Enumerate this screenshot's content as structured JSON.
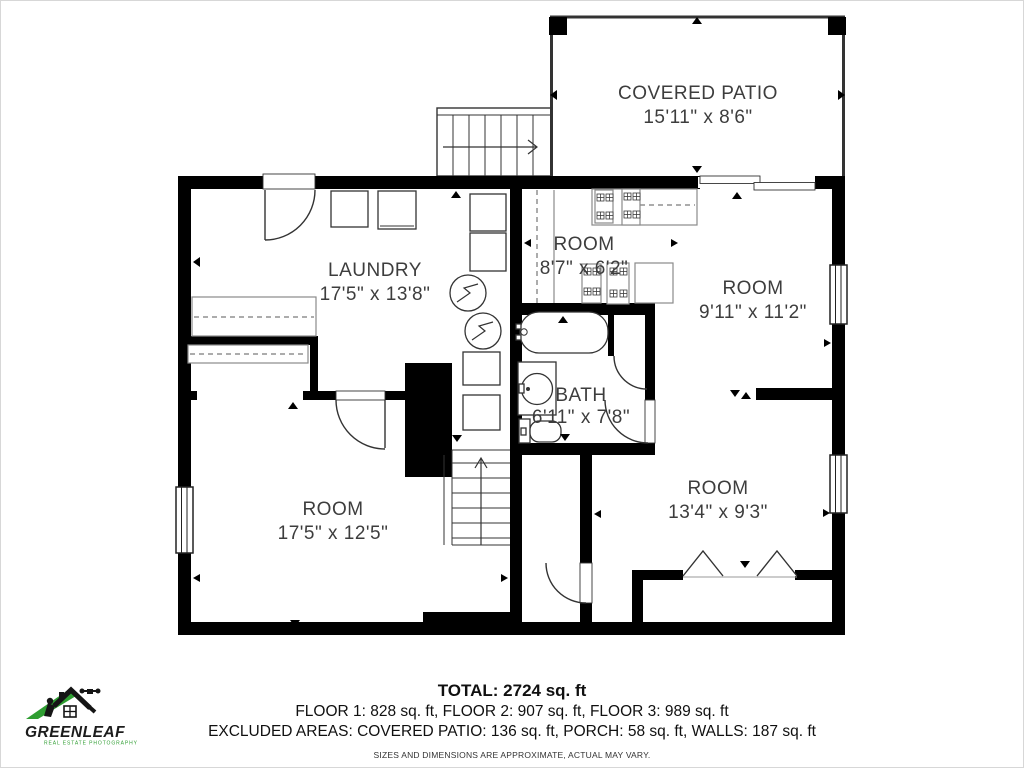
{
  "plan": {
    "rooms": [
      {
        "name": "COVERED PATIO",
        "dims": "15'11\" x 8'6\""
      },
      {
        "name": "LAUNDRY",
        "dims": "17'5\" x 13'8\""
      },
      {
        "name": "ROOM",
        "dims": "8'7\" x 6'2\""
      },
      {
        "name": "ROOM",
        "dims": "9'11\" x 11'2\""
      },
      {
        "name": "BATH",
        "dims": "6'11\" x 7'8\""
      },
      {
        "name": "ROOM",
        "dims": "17'5\" x 12'5\""
      },
      {
        "name": "ROOM",
        "dims": "13'4\" x 9'3\""
      }
    ],
    "colors": {
      "wall": "#000000",
      "label": "#3d3d3d",
      "line": "#333333"
    }
  },
  "summary": {
    "total": "TOTAL: 2724 sq. ft",
    "floors": "FLOOR 1: 828 sq. ft, FLOOR 2: 907 sq. ft, FLOOR 3: 989 sq. ft",
    "excluded": "EXCLUDED AREAS: COVERED PATIO: 136 sq. ft, PORCH: 58 sq. ft, WALLS: 187 sq. ft",
    "disclaimer": "SIZES AND DIMENSIONS ARE APPROXIMATE, ACTUAL MAY VARY."
  },
  "logo": {
    "brand": "GREENLEAF",
    "tagline": "REAL ESTATE PHOTOGRAPHY",
    "accent": "#2f9e32"
  }
}
